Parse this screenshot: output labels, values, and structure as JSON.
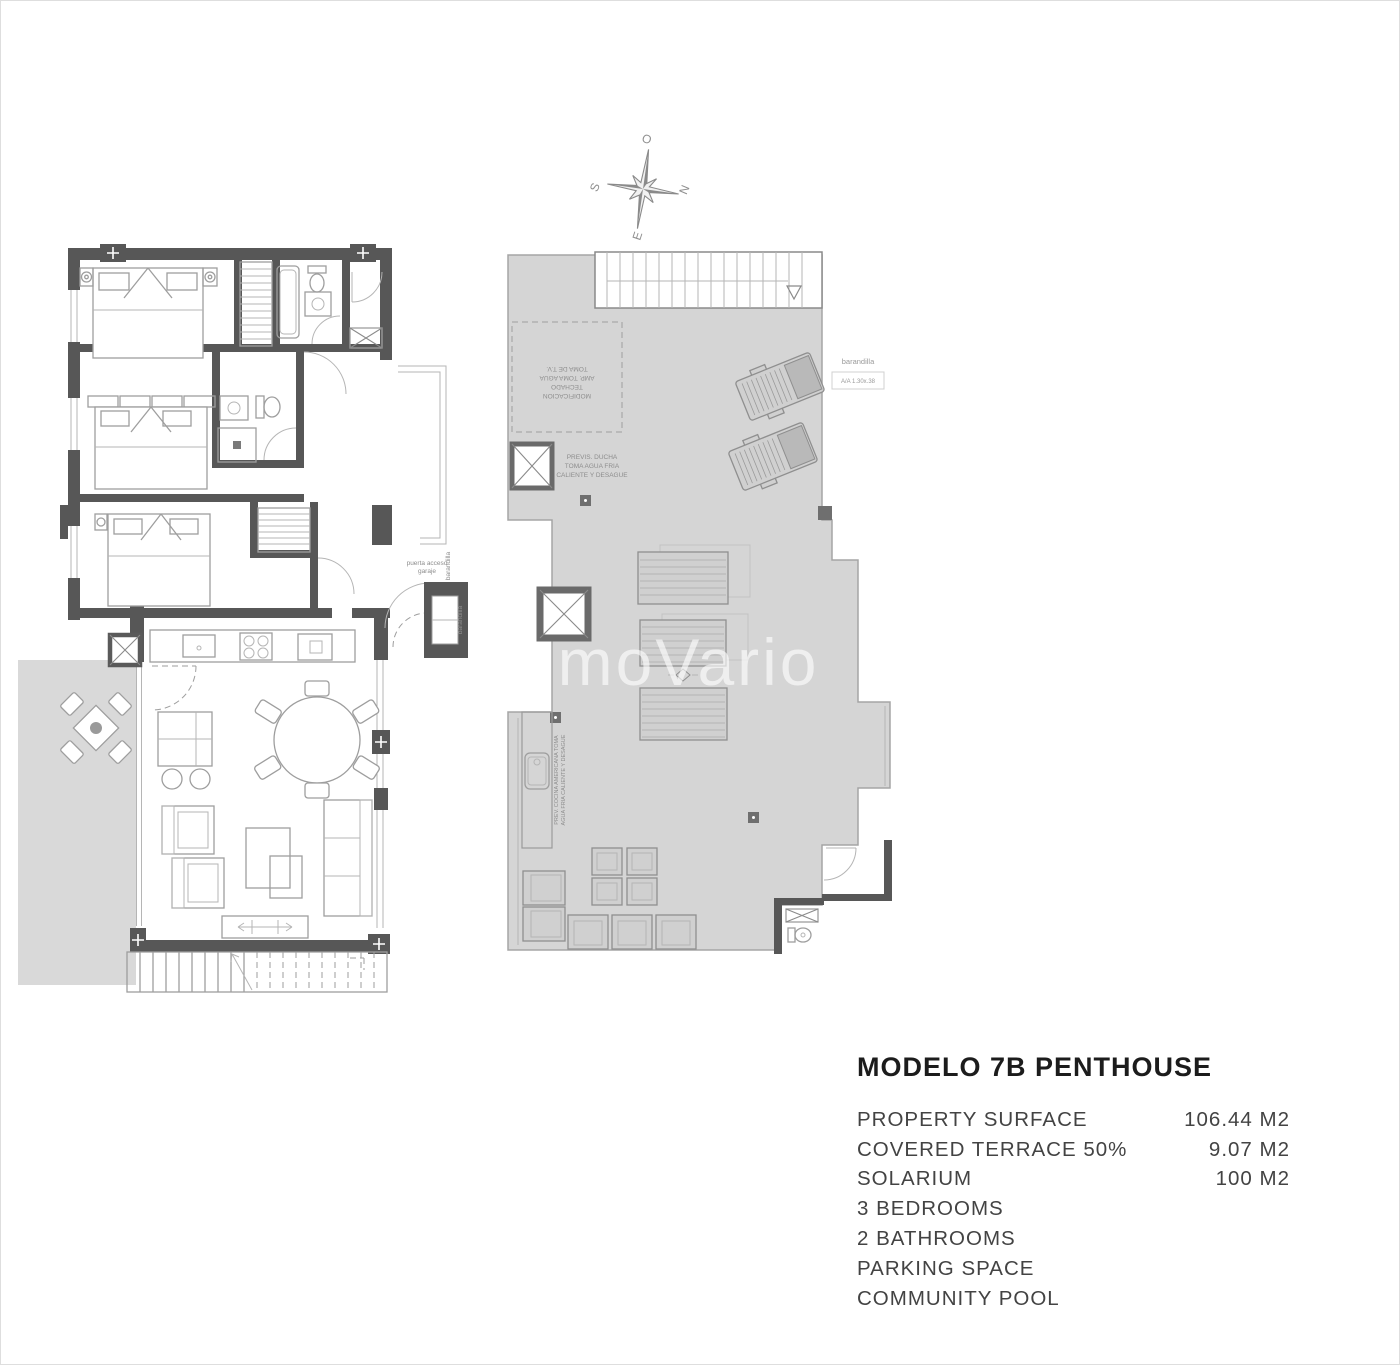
{
  "compass": {
    "top": "O",
    "right": "N",
    "left": "S",
    "bottom": "E"
  },
  "watermark": "immoVario",
  "left_plan": {
    "door_note": [
      "puerta acceso",
      "garaje"
    ],
    "railing_label_1": "barandilla",
    "railing_label_2": "barandilla"
  },
  "right_plan": {
    "railing_label": "barandilla",
    "ac_unit_label": "A/A 1.30x.38",
    "shower_note": [
      "PREVIS. DUCHA",
      "TOMA AGUA FRIA",
      "CALIENTE Y DESAGUE"
    ],
    "canopy_note": [
      "MODIFICACION",
      "TECHADO",
      "AMP. TOMA AGUA",
      "TOMA DE T.V."
    ],
    "kitchen_note": [
      "PREV. COCINA AMERICANA TOMA",
      "AGUA FRIA CALIENTE Y DESAGUE"
    ]
  },
  "specs": {
    "title": "MODELO 7B PENTHOUSE",
    "rows": [
      {
        "label": "PROPERTY SURFACE",
        "value": "106.44 M2"
      },
      {
        "label": "COVERED TERRACE 50%",
        "value": "9.07 M2"
      },
      {
        "label": "SOLARIUM",
        "value": "100 M2"
      },
      {
        "label": "3 BEDROOMS",
        "value": ""
      },
      {
        "label": "2 BATHROOMS",
        "value": ""
      },
      {
        "label": "PARKING SPACE",
        "value": ""
      },
      {
        "label": "COMMUNITY POOL",
        "value": ""
      }
    ]
  },
  "colors": {
    "wall": "#575757",
    "solarium_fill": "#d5d5d5",
    "terrace_fill": "#d9d9d9",
    "furniture_line": "#9e9e9e",
    "annotation": "#8d8d8d",
    "title_text": "#1c1c1c",
    "spec_text": "#434343",
    "watermark": "rgba(255,255,255,0.62)"
  }
}
